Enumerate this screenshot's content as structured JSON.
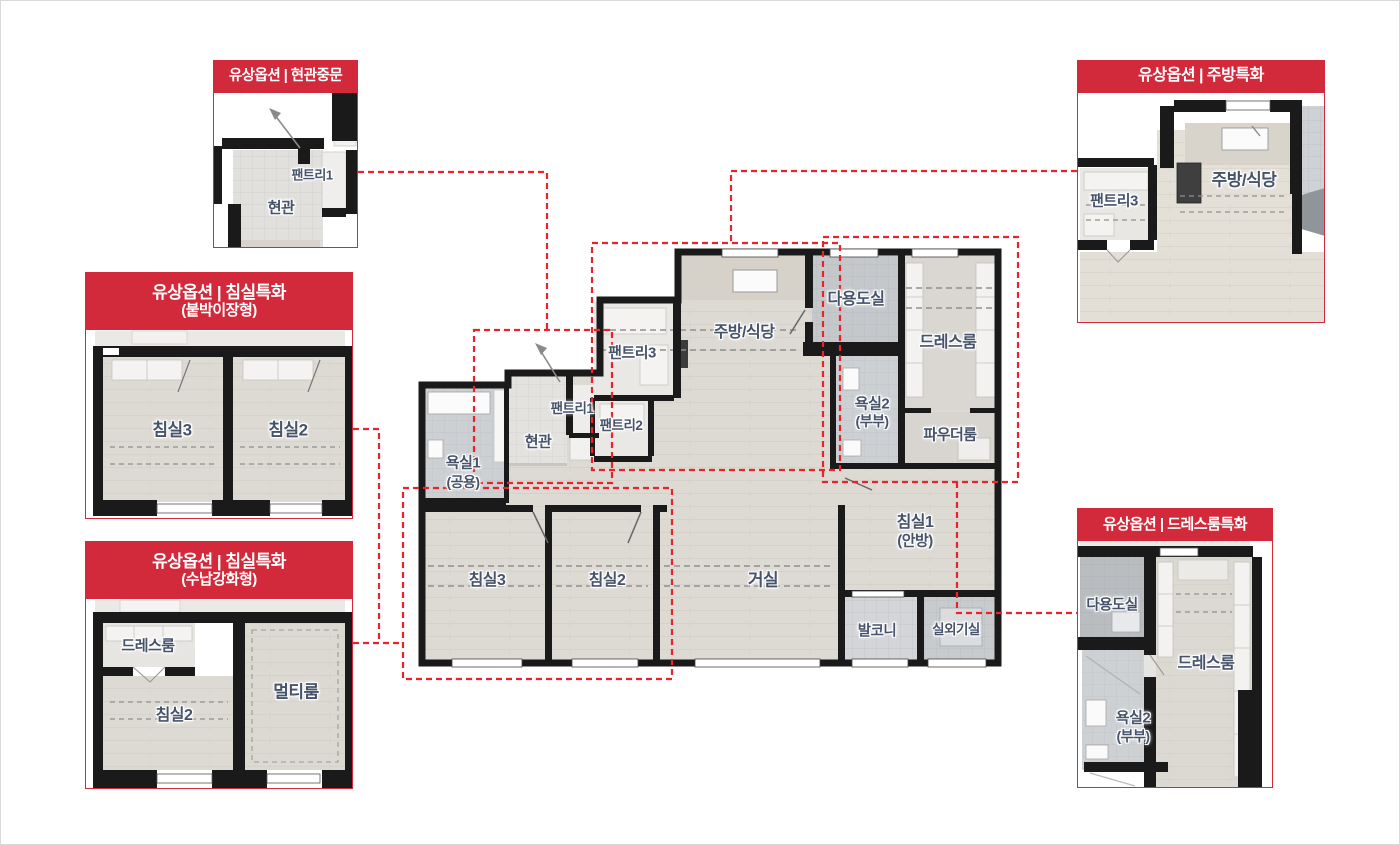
{
  "colors": {
    "accent_red": "#d2293b",
    "overlay_red": "#e8232c",
    "wall_black": "#1a1a1a",
    "label_navy": "#46536b"
  },
  "panels": {
    "entrance_door": {
      "title": "유상옵션 | 현관중문",
      "rooms": {
        "pantry1": "팬트리1",
        "entry": "현관"
      }
    },
    "bedroom_builtin": {
      "title": "유상옵션 | 침실특화",
      "subtitle": "(붙박이장형)",
      "rooms": {
        "bed3": "침실3",
        "bed2": "침실2"
      }
    },
    "bedroom_storage": {
      "title": "유상옵션 | 침실특화",
      "subtitle": "(수납강화형)",
      "rooms": {
        "dressroom": "드레스룸",
        "multi": "멀티룸",
        "bed2": "침실2"
      }
    },
    "kitchen": {
      "title": "유상옵션 | 주방특화",
      "rooms": {
        "pantry3": "팬트리3",
        "kitchen": "주방/식당"
      }
    },
    "dressroom": {
      "title": "유상옵션 | 드레스룸특화",
      "rooms": {
        "utility": "다용도실",
        "dressroom": "드레스룸",
        "bath2": "욕실2",
        "bath2_sub": "(부부)"
      }
    }
  },
  "main_plan": {
    "rooms": {
      "entry": "현관",
      "pantry1": "팬트리1",
      "pantry2": "팬트리2",
      "pantry3": "팬트리3",
      "bath1": "욕실1",
      "bath1_sub": "(공용)",
      "kitchen": "주방/식당",
      "utility": "다용도실",
      "dressroom": "드레스룸",
      "bath2": "욕실2",
      "bath2_sub": "(부부)",
      "powder": "파우더룸",
      "bed1": "침실1",
      "bed1_sub": "(안방)",
      "bed2": "침실2",
      "bed3": "침실3",
      "living": "거실",
      "balcony": "발코니",
      "outdoor_unit": "실외기실"
    }
  }
}
